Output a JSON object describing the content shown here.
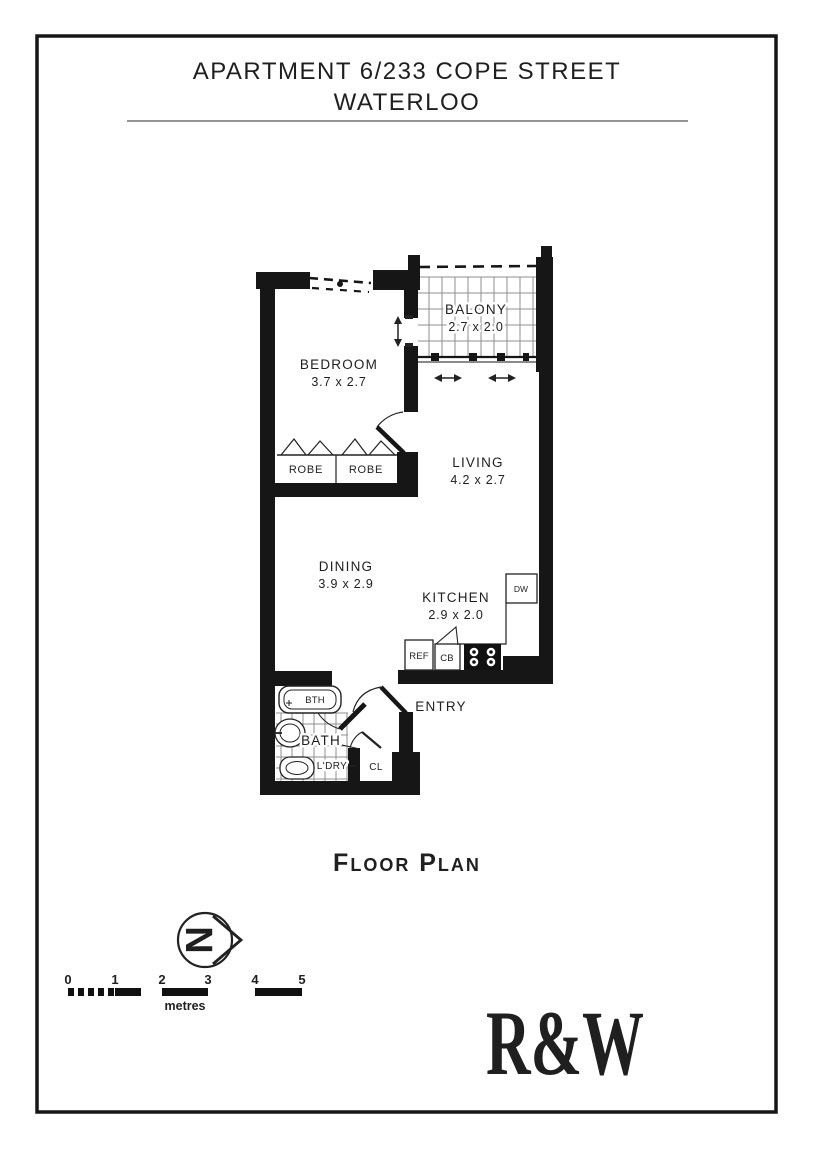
{
  "page": {
    "title_line1": "APARTMENT 6/233 COPE STREET",
    "title_line2": "WATERLOO",
    "caption": "Floor Plan",
    "compass_letter": "N"
  },
  "rooms": {
    "balcony": {
      "label": "BALONY",
      "dims": "2.7 x 2.0"
    },
    "bedroom": {
      "label": "BEDROOM",
      "dims": "3.7 x 2.7"
    },
    "living": {
      "label": "LIVING",
      "dims": "4.2 x 2.7"
    },
    "dining": {
      "label": "DINING",
      "dims": "3.9 x 2.9"
    },
    "kitchen": {
      "label": "KITCHEN",
      "dims": "2.9 x 2.0"
    },
    "entry": {
      "label": "ENTRY"
    },
    "bath": {
      "label": "BATH"
    },
    "laundry": {
      "label": "L'DRY"
    },
    "closet": {
      "label": "CL"
    }
  },
  "fixtures": {
    "robe_left": "ROBE",
    "robe_right": "ROBE",
    "bathtub": "BTH",
    "fridge": "REF",
    "cupboard": "CB",
    "dishwasher": "DW"
  },
  "scale_bar": {
    "ticks": [
      "0",
      "1",
      "2",
      "3",
      "4",
      "5"
    ],
    "unit": "metres"
  },
  "logo": {
    "text": "R&W",
    "color": "#E42229"
  }
}
